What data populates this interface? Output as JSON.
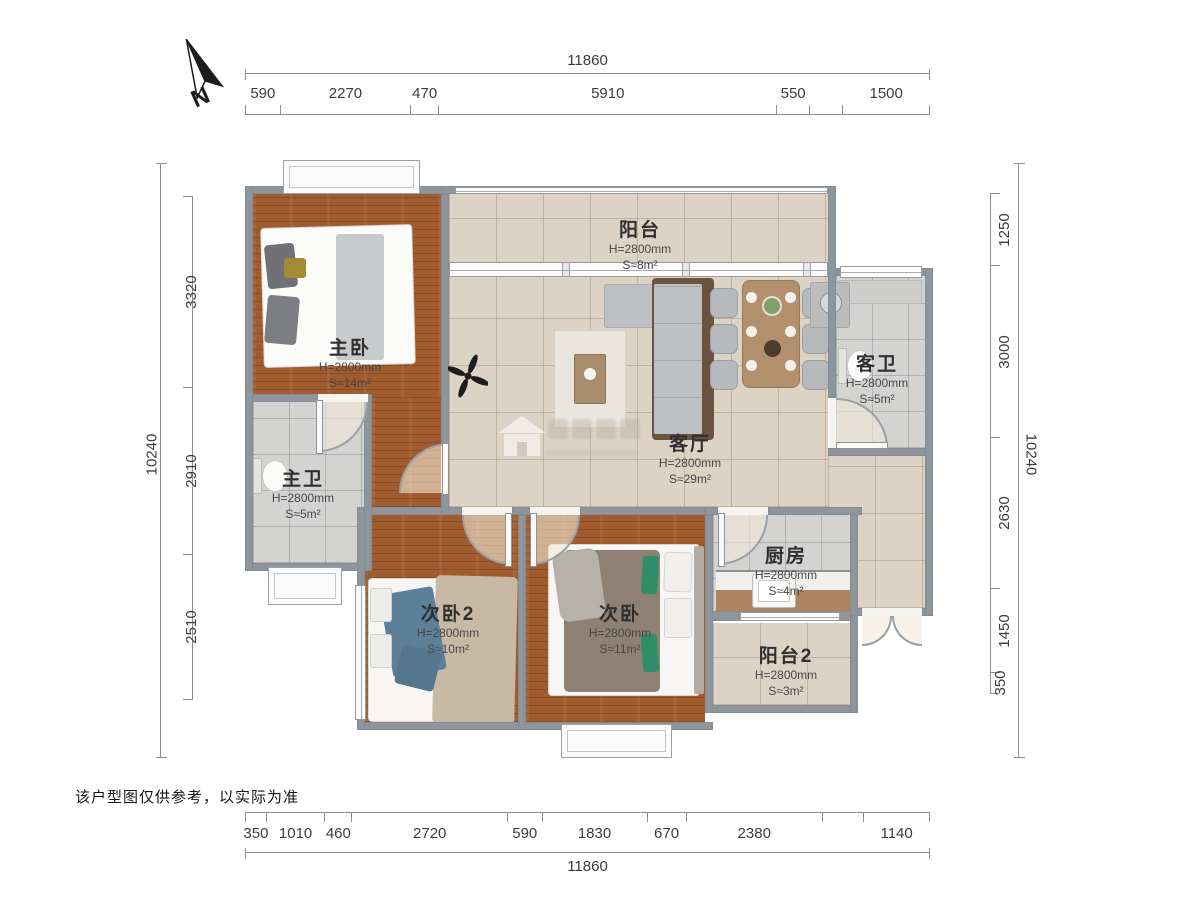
{
  "compass": {
    "label": "N"
  },
  "disclaimer": "该户型图仅供参考，以实际为准",
  "dimensions": {
    "top": {
      "total": "11860",
      "segments": [
        "590",
        "2270",
        "470",
        "5910",
        "550",
        "1500"
      ]
    },
    "bottom": {
      "total": "11860",
      "segments": [
        "350",
        "1010",
        "460",
        "2720",
        "590",
        "1830",
        "670",
        "2380",
        "1140"
      ]
    },
    "left": {
      "total": "10240",
      "segments": [
        "3320",
        "2910",
        "2510"
      ]
    },
    "right": {
      "total": "10240",
      "segments": [
        "1250",
        "3000",
        "2630",
        "1450",
        "350"
      ]
    }
  },
  "rooms": [
    {
      "id": "master-bedroom",
      "name": "主卧",
      "height": "H=2800mm",
      "area": "S≈14m²"
    },
    {
      "id": "balcony",
      "name": "阳台",
      "height": "H=2800mm",
      "area": "S≈8m²"
    },
    {
      "id": "living-room",
      "name": "客厅",
      "height": "H=2800mm",
      "area": "S≈29m²"
    },
    {
      "id": "guest-bathroom",
      "name": "客卫",
      "height": "H=2800mm",
      "area": "S≈5m²"
    },
    {
      "id": "master-bathroom",
      "name": "主卫",
      "height": "H=2800mm",
      "area": "S≈5m²"
    },
    {
      "id": "bedroom-2",
      "name": "次卧2",
      "height": "H=2800mm",
      "area": "S≈10m²"
    },
    {
      "id": "bedroom",
      "name": "次卧",
      "height": "H=2800mm",
      "area": "S≈11m²"
    },
    {
      "id": "kitchen",
      "name": "厨房",
      "height": "H=2800mm",
      "area": "S≈4m²"
    },
    {
      "id": "balcony-2",
      "name": "阳台2",
      "height": "H=2800mm",
      "area": "S≈3m²"
    }
  ],
  "colors": {
    "wall": "#8f959c",
    "wood_floor": "#a05c2f",
    "tile_beige": "#ddd3c5",
    "tile_gray": "#d3d3d2",
    "door_arc": "#9aa0a6",
    "dimension_text": "#3b3b3b",
    "accent_green": "#2f8e68",
    "accent_blue": "#5c7f9a"
  }
}
